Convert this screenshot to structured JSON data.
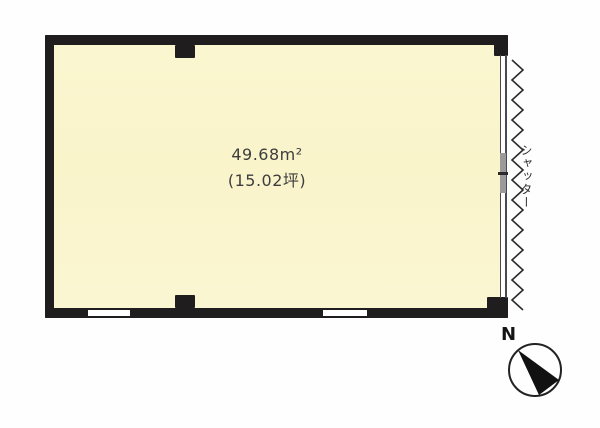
{
  "floorplan": {
    "room": {
      "area_m2": "49.68m²",
      "area_tsubo": "(15.02坪)"
    },
    "shutter": {
      "label": "シャッター"
    },
    "compass": {
      "north_label": "N"
    },
    "colors": {
      "wall": "#1f1d1d",
      "floor": "#f9f5cf",
      "background": "#fefefe",
      "shutter_panel": "#9a9a9a",
      "line": "#4a4a4a",
      "text": "#3d3d3d"
    }
  }
}
